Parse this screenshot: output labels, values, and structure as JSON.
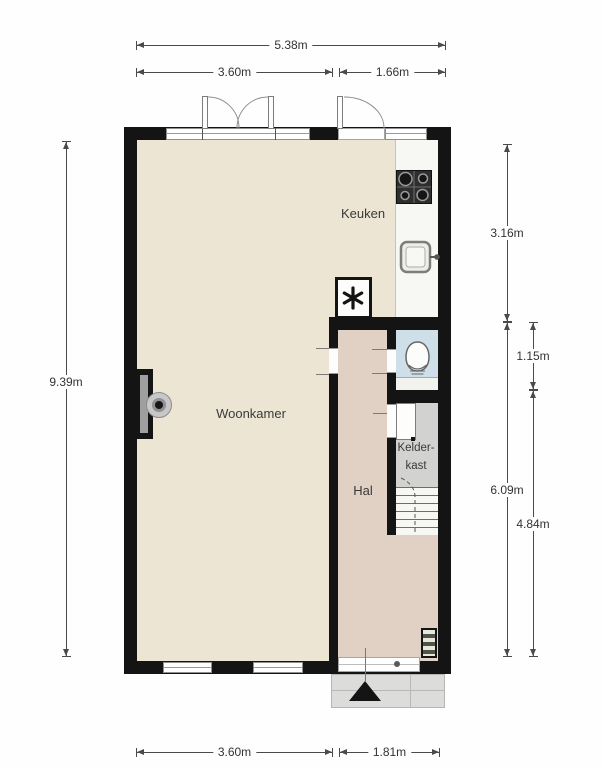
{
  "rooms": {
    "woonkamer": "Woonkamer",
    "keuken": "Keuken",
    "hal": "Hal",
    "kelderkast_line1": "Kelder-",
    "kelderkast_line2": "kast"
  },
  "dimensions": {
    "top_total": "5.38m",
    "top_left": "3.60m",
    "top_right": "1.66m",
    "left_height": "9.39m",
    "right_kitchen": "3.16m",
    "right_toilet": "1.15m",
    "right_lower": "6.09m",
    "right_hall": "4.84m",
    "bottom_left": "3.60m",
    "bottom_right": "1.81m"
  },
  "icons": {
    "stove": "stove-burners-icon",
    "sink": "kitchen-sink-icon",
    "toilet": "toilet-icon",
    "boiler": "boiler-asterisk-icon",
    "chimney": "chimney-flue-icon",
    "meter": "meter-cabinet-icon",
    "entrance": "entrance-arrow-icon",
    "stairs": "staircase-icon",
    "door_swing": "door-swing-arc-icon"
  },
  "colors": {
    "wall": "#141414",
    "living_floor": "#ece5d3",
    "hall_floor": "#e1d0c4",
    "toilet_floor": "#cedfea",
    "closet_floor": "#d2d2d0",
    "counter": "#f7f7f3",
    "stoop": "#dcdcda",
    "dimension_line": "#4a4a4a"
  }
}
